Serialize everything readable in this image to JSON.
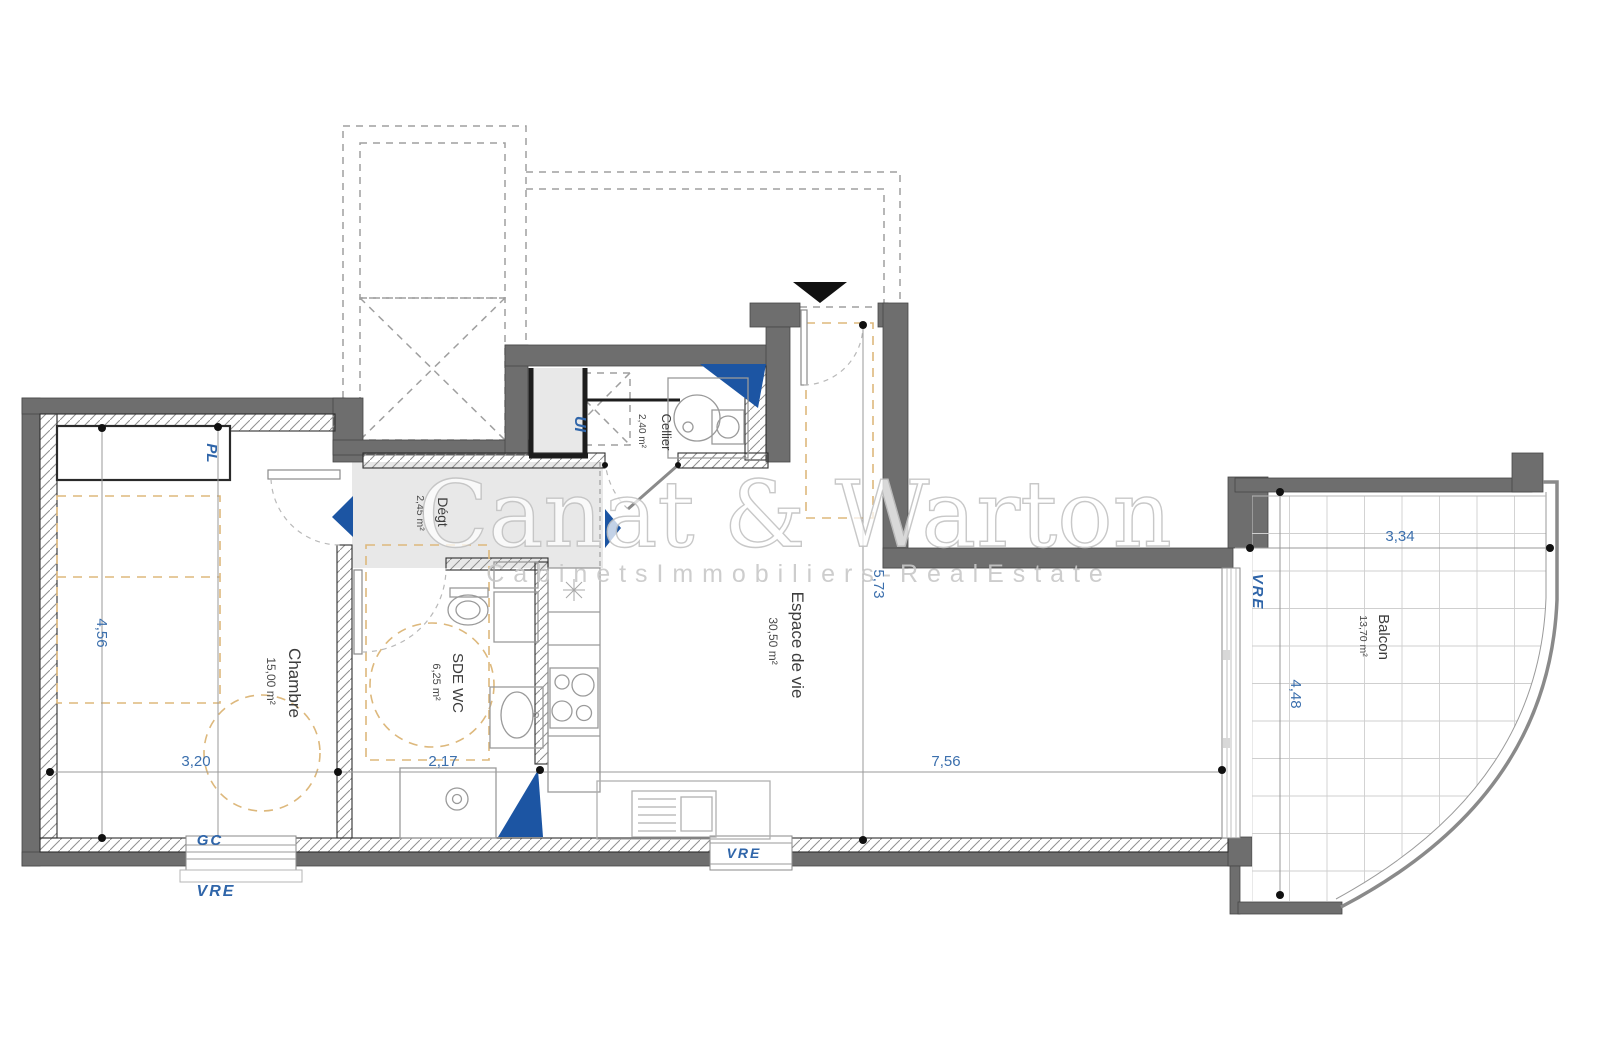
{
  "watermark": {
    "brand": "Canat & Warton",
    "subtitle": "C a b i n e t s   I m m o b i l i e r s   -   R e a l   E s t a t e"
  },
  "rooms": {
    "chambre": {
      "name": "Chambre",
      "area": "15,00 m²"
    },
    "sde_wc": {
      "name": "SDE WC",
      "area": "6,25 m²"
    },
    "degt": {
      "name": "Dégt",
      "area": "2,45 m²"
    },
    "cellier": {
      "name": "Cellier",
      "area": "2,40 m²"
    },
    "living": {
      "name": "Espace de vie",
      "area": "30,50 m²"
    },
    "balcon": {
      "name": "Balcon",
      "area": "13,70 m²"
    }
  },
  "closets": {
    "placard": "PL",
    "ui": "UI"
  },
  "openings": {
    "gc": "GC",
    "vre_left": "VRE",
    "vre_center": "VRE",
    "vre_right": "VRE"
  },
  "dimensions": {
    "chambre_height": "4,56",
    "chambre_width": "3,20",
    "sde_width": "2,17",
    "living_width": "7,56",
    "living_height": "5,73",
    "balcon_width": "3,34",
    "balcon_depth": "4,48"
  },
  "colors": {
    "wall": "#6e6e6e",
    "accent_blue": "#1c55a3",
    "label_blue": "#2f65a9",
    "dim_blue": "#3b6fad",
    "furniture_hint": "#ddb87c",
    "floor_shaded": "#e8e8e8"
  }
}
